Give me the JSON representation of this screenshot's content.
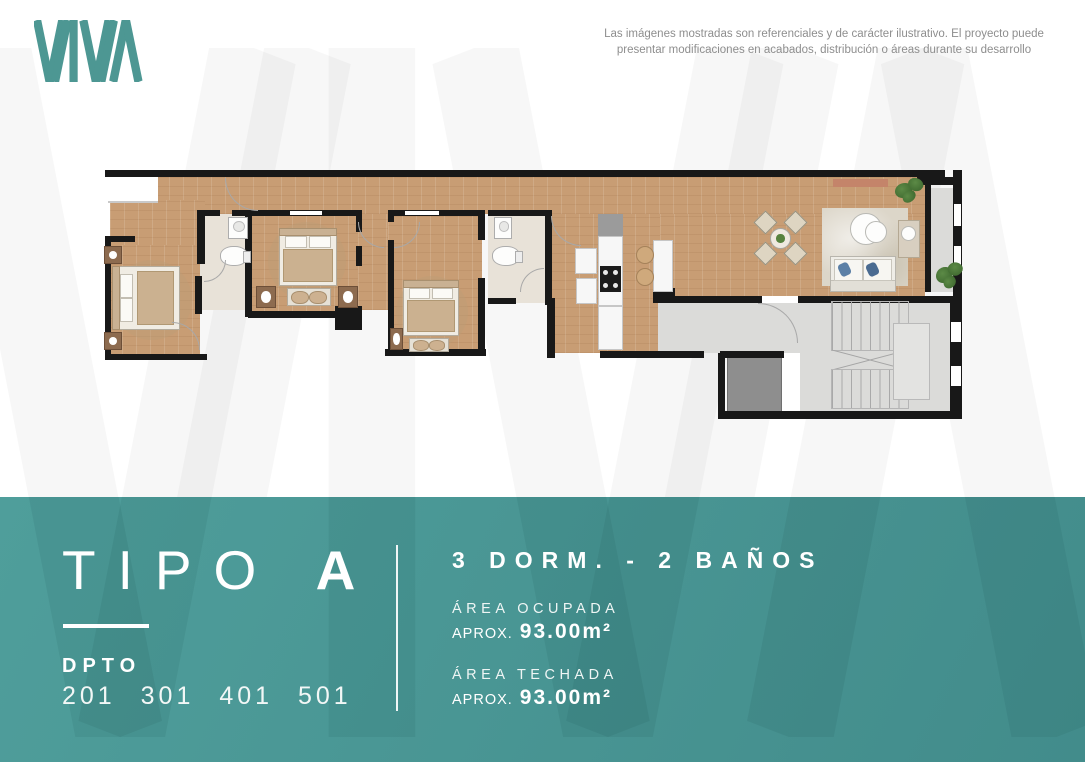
{
  "brand": {
    "logo_text": "VIVA",
    "teal": "#4d9793"
  },
  "watermark_text": "VIVA",
  "disclaimer": {
    "line1": "Las imágenes mostradas son referenciales y de carácter ilustrativo. El proyecto puede",
    "line2": "presentar modificaciones en acabados, distribución o áreas durante su desarrollo"
  },
  "band": {
    "background": "#4a9795",
    "type_label": "TIPO",
    "type_letter": "A",
    "dpto_label": "DPTO",
    "unit_numbers": "201 301 401 501",
    "rooms_line": "3 DORM. - 2 BAÑOS",
    "areas": [
      {
        "label": "ÁREA OCUPADA",
        "prefix": "APROX.",
        "value": "93.00m²"
      },
      {
        "label": "ÁREA TECHADA",
        "prefix": "APROX.",
        "value": "93.00m²"
      }
    ]
  }
}
